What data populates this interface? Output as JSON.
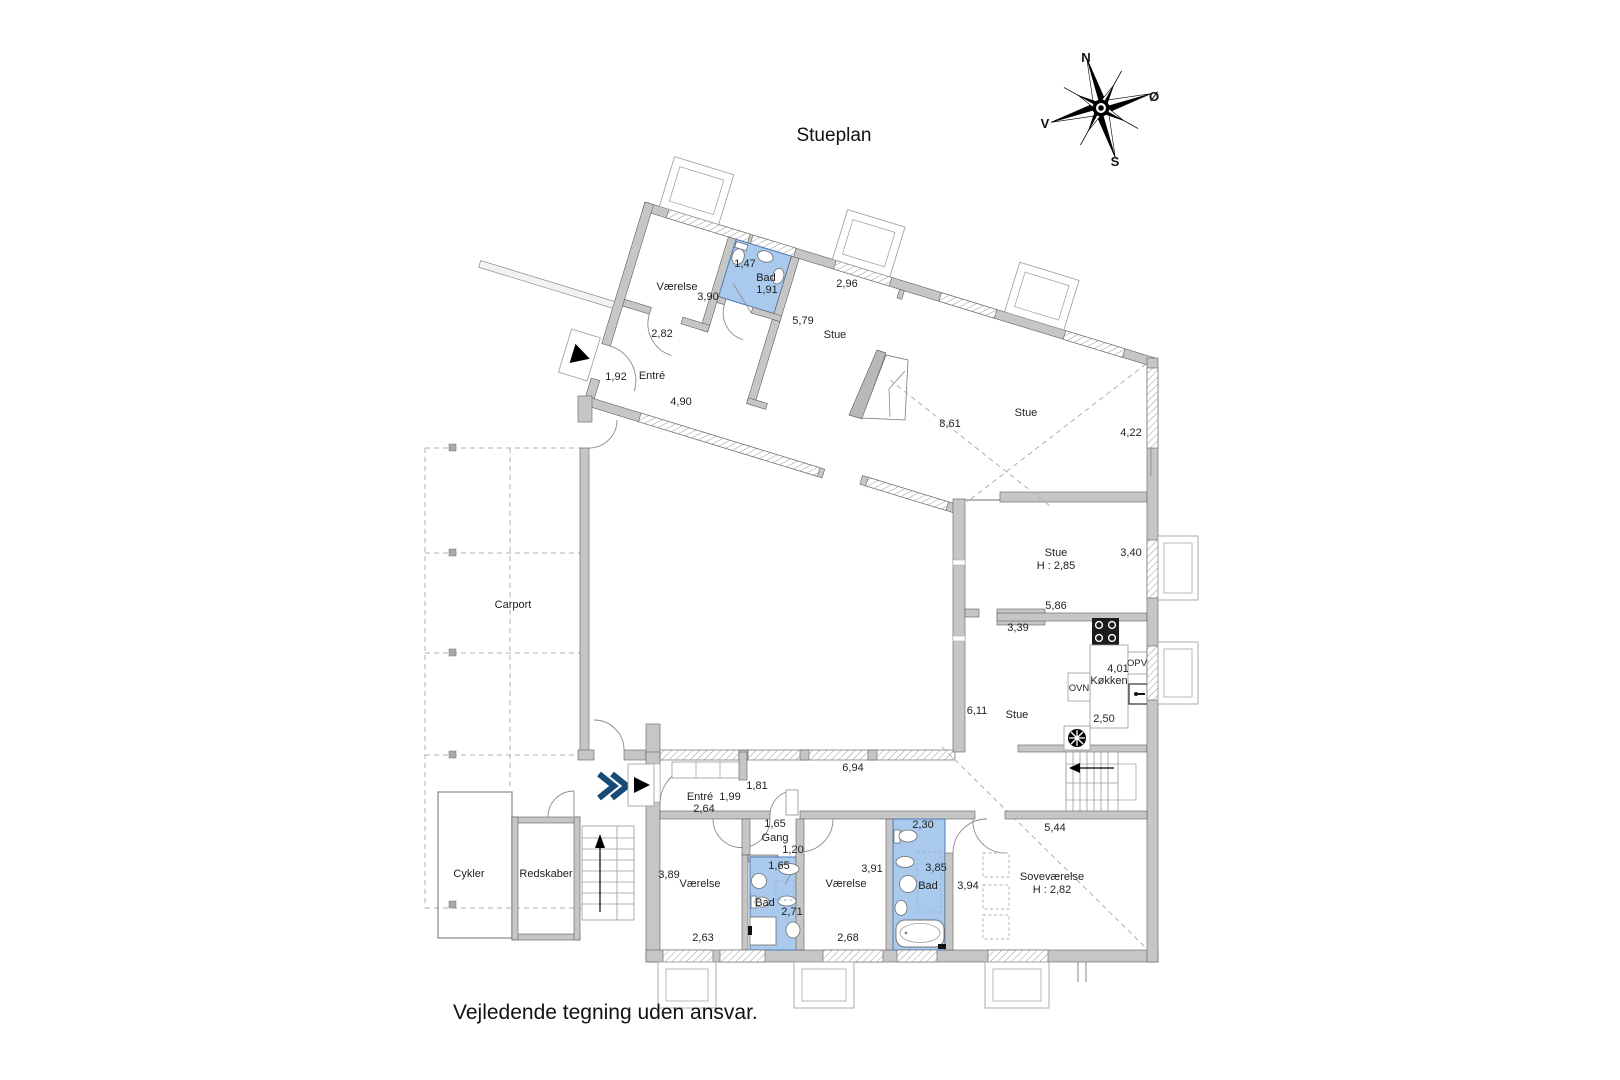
{
  "title": "Stueplan",
  "footer": "Vejledende tegning uden ansvar.",
  "compass": {
    "north": "N",
    "east": "Ø",
    "south": "S",
    "west": "V"
  },
  "colors": {
    "wall": "#c6c6c6",
    "bath_fill": "#a9c9ed",
    "bath_stroke": "#4d7ab8",
    "entry_arrow": "#174a77"
  },
  "plan": {
    "labels": [
      {
        "text": "Værelse",
        "x": 677,
        "y": 290,
        "cls": "room"
      },
      {
        "text": "3,90",
        "x": 708,
        "y": 300,
        "cls": "dim"
      },
      {
        "text": "1,47",
        "x": 745,
        "y": 267,
        "cls": "dim"
      },
      {
        "text": "Bad",
        "x": 766,
        "y": 281,
        "cls": "room"
      },
      {
        "text": "1,91",
        "x": 767,
        "y": 293,
        "cls": "dim"
      },
      {
        "text": "2,96",
        "x": 847,
        "y": 287,
        "cls": "dim"
      },
      {
        "text": "2,82",
        "x": 662,
        "y": 337,
        "cls": "dim"
      },
      {
        "text": "5,79",
        "x": 803,
        "y": 324,
        "cls": "dim"
      },
      {
        "text": "Stue",
        "x": 835,
        "y": 338,
        "cls": "room"
      },
      {
        "text": "1,92",
        "x": 616,
        "y": 380,
        "cls": "dim"
      },
      {
        "text": "Entré",
        "x": 652,
        "y": 379,
        "cls": "room"
      },
      {
        "text": "4,90",
        "x": 681,
        "y": 405,
        "cls": "dim"
      },
      {
        "text": "8,61",
        "x": 950,
        "y": 427,
        "cls": "dim"
      },
      {
        "text": "Stue",
        "x": 1026,
        "y": 416,
        "cls": "room"
      },
      {
        "text": "4,22",
        "x": 1131,
        "y": 436,
        "cls": "dim"
      },
      {
        "text": "Stue",
        "x": 1056,
        "y": 556,
        "cls": "room"
      },
      {
        "text": "H : 2,85",
        "x": 1056,
        "y": 569,
        "cls": "dim"
      },
      {
        "text": "3,40",
        "x": 1131,
        "y": 556,
        "cls": "dim"
      },
      {
        "text": "5,86",
        "x": 1056,
        "y": 609,
        "cls": "dim"
      },
      {
        "text": "3,39",
        "x": 1018,
        "y": 631,
        "cls": "dim"
      },
      {
        "text": "OVN",
        "x": 1079,
        "y": 691,
        "cls": "small"
      },
      {
        "text": "Køkken",
        "x": 1109,
        "y": 684,
        "cls": "room"
      },
      {
        "text": "4,01",
        "x": 1118,
        "y": 672,
        "cls": "dim"
      },
      {
        "text": "OPV",
        "x": 1137,
        "y": 666,
        "cls": "small"
      },
      {
        "text": "2,50",
        "x": 1104,
        "y": 722,
        "cls": "dim"
      },
      {
        "text": "6,11",
        "x": 977,
        "y": 714,
        "cls": "dim"
      },
      {
        "text": "Stue",
        "x": 1017,
        "y": 718,
        "cls": "room"
      },
      {
        "text": "Carport",
        "x": 513,
        "y": 608,
        "cls": "room"
      },
      {
        "text": "6,94",
        "x": 853,
        "y": 771,
        "cls": "dim"
      },
      {
        "text": "1,81",
        "x": 757,
        "y": 789,
        "cls": "dim"
      },
      {
        "text": "Entré",
        "x": 700,
        "y": 800,
        "cls": "room"
      },
      {
        "text": "1,99",
        "x": 730,
        "y": 800,
        "cls": "dim"
      },
      {
        "text": "2,64",
        "x": 704,
        "y": 812,
        "cls": "dim"
      },
      {
        "text": "1,65",
        "x": 775,
        "y": 827,
        "cls": "dim"
      },
      {
        "text": "Gang",
        "x": 775,
        "y": 841,
        "cls": "room"
      },
      {
        "text": "1,20",
        "x": 793,
        "y": 853,
        "cls": "dim"
      },
      {
        "text": "2,30",
        "x": 923,
        "y": 828,
        "cls": "dim"
      },
      {
        "text": "5,44",
        "x": 1055,
        "y": 831,
        "cls": "dim"
      },
      {
        "text": "Cykler",
        "x": 469,
        "y": 877,
        "cls": "room"
      },
      {
        "text": "Redskaber",
        "x": 546,
        "y": 877,
        "cls": "room"
      },
      {
        "text": "3,89",
        "x": 669,
        "y": 878,
        "cls": "dim"
      },
      {
        "text": "Værelse",
        "x": 700,
        "y": 887,
        "cls": "room"
      },
      {
        "text": "1,65",
        "x": 779,
        "y": 869,
        "cls": "dim"
      },
      {
        "text": "Bad",
        "x": 765,
        "y": 906,
        "cls": "room"
      },
      {
        "text": "2,71",
        "x": 792,
        "y": 915,
        "cls": "dim"
      },
      {
        "text": "2,63",
        "x": 703,
        "y": 941,
        "cls": "dim"
      },
      {
        "text": "3,91",
        "x": 872,
        "y": 872,
        "cls": "dim"
      },
      {
        "text": "Værelse",
        "x": 846,
        "y": 887,
        "cls": "room"
      },
      {
        "text": "2,68",
        "x": 848,
        "y": 941,
        "cls": "dim"
      },
      {
        "text": "3,85",
        "x": 936,
        "y": 871,
        "cls": "dim"
      },
      {
        "text": "Bad",
        "x": 928,
        "y": 889,
        "cls": "room"
      },
      {
        "text": "3,94",
        "x": 968,
        "y": 889,
        "cls": "dim"
      },
      {
        "text": "Soveværelse",
        "x": 1052,
        "y": 880,
        "cls": "room"
      },
      {
        "text": "H : 2,82",
        "x": 1052,
        "y": 893,
        "cls": "dim"
      }
    ]
  }
}
